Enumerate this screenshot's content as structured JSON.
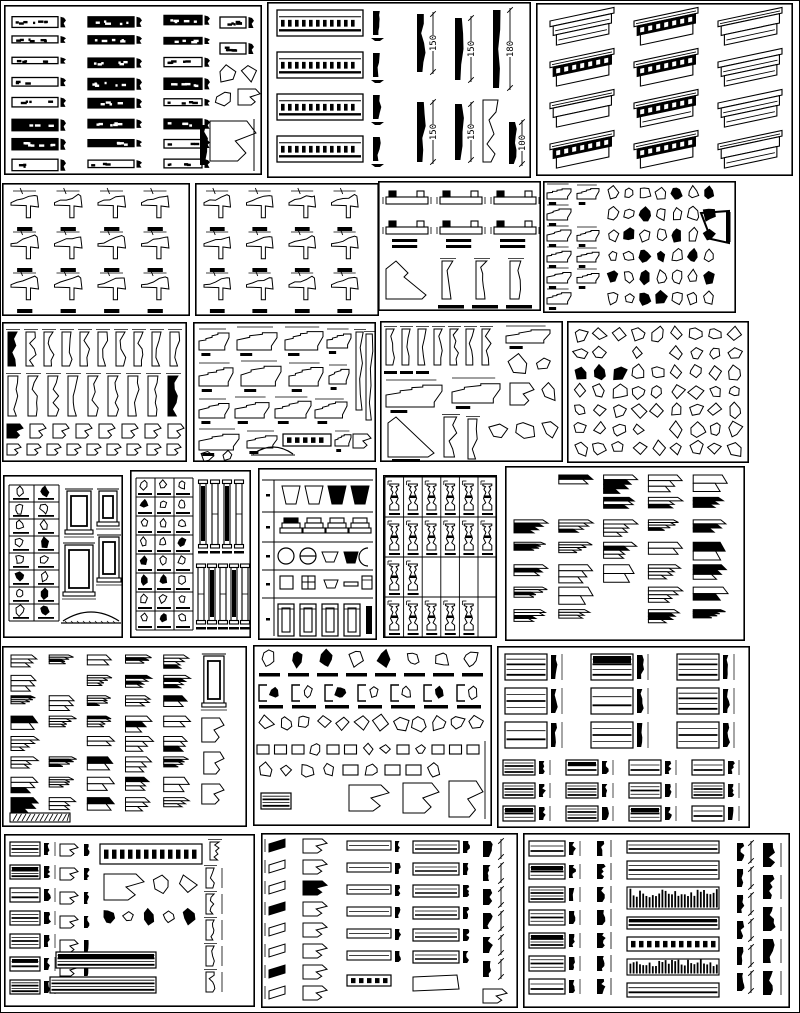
{
  "sheet": {
    "width": 800,
    "height": 1013,
    "background": "#ffffff",
    "ink": "#000000",
    "description": "CAD block library sheet - architectural cornice, molding, baluster and trim details"
  },
  "dimension_labels": [
    "150",
    "150",
    "180",
    "150",
    "150",
    "100"
  ],
  "panels": [
    {
      "id": "cornice-elevation-strips",
      "kind": "bars",
      "x": 4,
      "y": 5,
      "w": 258,
      "h": 170
    },
    {
      "id": "cornice-profiles-dimensioned",
      "kind": "cornice-dim",
      "x": 267,
      "y": 2,
      "w": 264,
      "h": 176
    },
    {
      "id": "crown-molding-isometrics",
      "kind": "iso",
      "x": 536,
      "y": 3,
      "w": 257,
      "h": 173,
      "rows": 4,
      "cols": 3
    },
    {
      "id": "eave-section-details-a",
      "kind": "sections",
      "x": 2,
      "y": 183,
      "w": 188,
      "h": 133,
      "rows": 3,
      "cols": 4
    },
    {
      "id": "eave-section-details-b",
      "kind": "sections",
      "x": 195,
      "y": 183,
      "w": 184,
      "h": 133,
      "rows": 3,
      "cols": 4
    },
    {
      "id": "beam-section-details",
      "kind": "beams",
      "x": 378,
      "y": 181,
      "w": 163,
      "h": 130
    },
    {
      "id": "small-profile-library",
      "kind": "dense",
      "x": 543,
      "y": 181,
      "w": 193,
      "h": 132
    },
    {
      "id": "molding-profile-strips",
      "kind": "profile-rows",
      "x": 2,
      "y": 322,
      "w": 185,
      "h": 140
    },
    {
      "id": "cornice-section-profiles",
      "kind": "cornice-sections",
      "x": 193,
      "y": 322,
      "w": 183,
      "h": 140
    },
    {
      "id": "mixed-section-profiles",
      "kind": "mixed-profiles",
      "x": 380,
      "y": 321,
      "w": 183,
      "h": 141
    },
    {
      "id": "bracket-outline-library",
      "kind": "poly-grid",
      "x": 567,
      "y": 321,
      "w": 182,
      "h": 142,
      "rows": 7,
      "cols": 9
    },
    {
      "id": "pedestal-panel-table",
      "kind": "table-panels",
      "x": 3,
      "y": 475,
      "w": 120,
      "h": 163
    },
    {
      "id": "baluster-column-table",
      "kind": "table-balusters",
      "x": 130,
      "y": 470,
      "w": 121,
      "h": 168
    },
    {
      "id": "capital-base-band-chart",
      "kind": "bands",
      "x": 258,
      "y": 468,
      "w": 119,
      "h": 172
    },
    {
      "id": "baluster-grid",
      "kind": "baluster-grid",
      "x": 383,
      "y": 475,
      "w": 114,
      "h": 163,
      "rows": 4,
      "cols": 6
    },
    {
      "id": "crown-profile-columns-a",
      "kind": "chevrons",
      "x": 505,
      "y": 466,
      "w": 240,
      "h": 175,
      "cols": 5,
      "rows": 7,
      "corbelCol": false
    },
    {
      "id": "crown-profile-columns-b",
      "kind": "chevrons",
      "x": 2,
      "y": 646,
      "w": 245,
      "h": 181,
      "cols": 6,
      "rows": 8,
      "corbelCol": true
    },
    {
      "id": "trim-fitting-mix",
      "kind": "dense-mixed",
      "x": 253,
      "y": 645,
      "w": 239,
      "h": 181
    },
    {
      "id": "casing-panel-moldings",
      "kind": "panel-moldings",
      "x": 497,
      "y": 646,
      "w": 253,
      "h": 182
    },
    {
      "id": "cornice-assembly-mix",
      "kind": "cornice-mix-a",
      "x": 4,
      "y": 834,
      "w": 251,
      "h": 173
    },
    {
      "id": "molding-3d-columns",
      "kind": "cornice-mix-b",
      "x": 261,
      "y": 833,
      "w": 257,
      "h": 175
    },
    {
      "id": "frieze-band-details",
      "kind": "cornice-mix-c",
      "x": 523,
      "y": 833,
      "w": 267,
      "h": 175
    }
  ]
}
